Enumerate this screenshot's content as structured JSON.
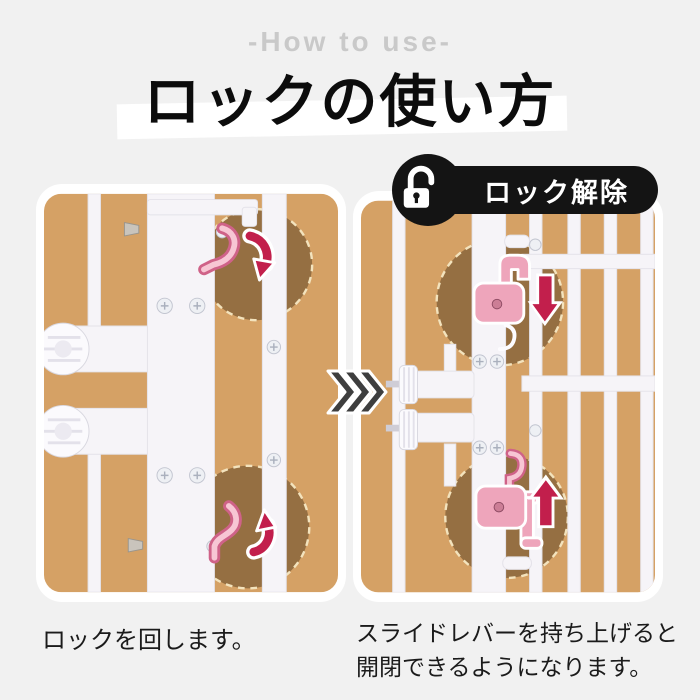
{
  "header": {
    "subtitle": "-How to use-",
    "title": "ロックの使い方"
  },
  "unlock_badge": {
    "label": "ロック解除",
    "icon": "unlock-icon"
  },
  "transition": {
    "arrow_icon": "triple-chevron-right"
  },
  "panels": {
    "left": {
      "illustration": "gate-lock-rotate-photo",
      "caption": "ロックを回します。"
    },
    "right": {
      "illustration": "gate-slide-lever-photo",
      "caption_lines": [
        "スライドレバーを持ち上げると",
        "開閉できるようになります。"
      ]
    }
  },
  "colors": {
    "page_bg": "#f1f1f1",
    "subtitle_text": "#c9c9c9",
    "title_text": "#0c0c0c",
    "title_band": "#ffffff",
    "badge_bg": "#141414",
    "badge_text": "#ffffff",
    "photo_bg": "#d5a165",
    "spotlight_brown": "#956f42",
    "spotlight_dash": "#f3e3bd",
    "gate_white": "#f6f4f8",
    "lock_pink": "#eea5bb",
    "lock_pink_edge": "#cf6288",
    "arrow_red": "#c21f4c",
    "chevron_gray": "#3e3e3e"
  }
}
